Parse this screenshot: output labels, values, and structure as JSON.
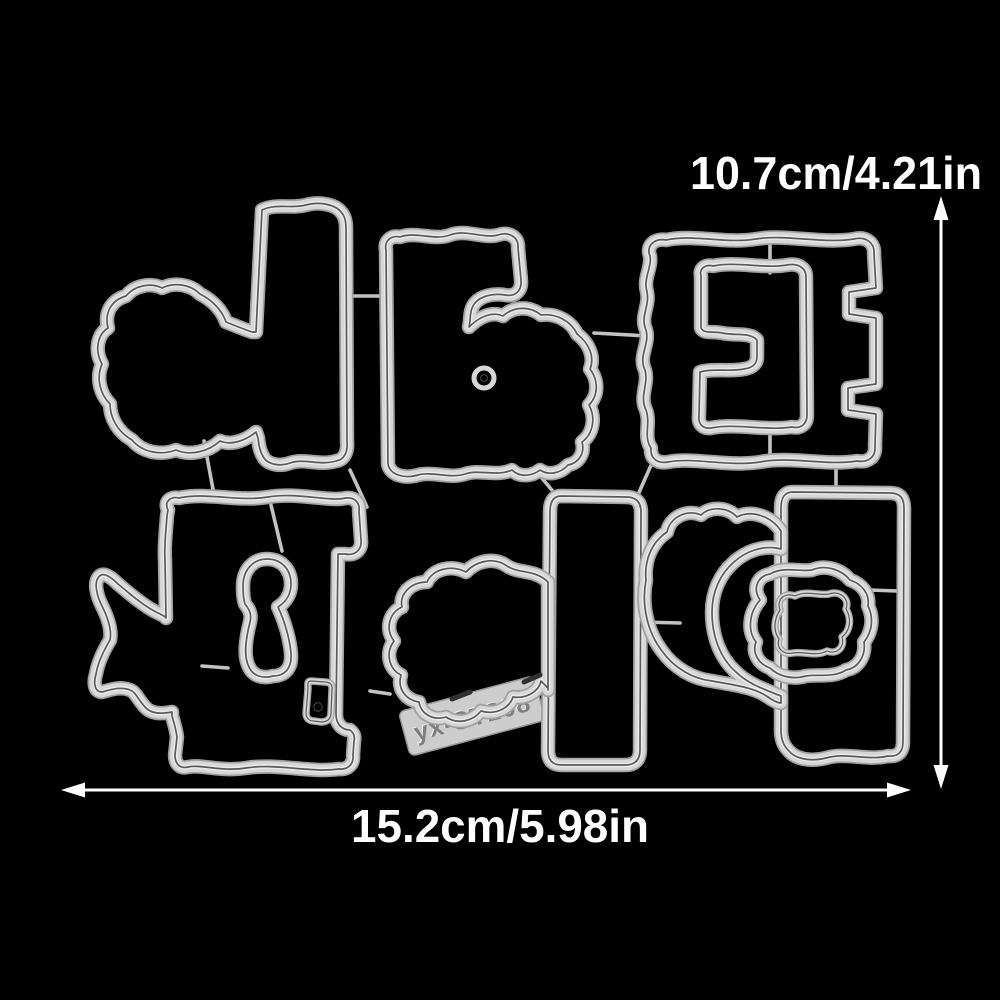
{
  "scene": {
    "description": "Metal craft cutting die set photographed on a black background with dimension annotations",
    "background_color": "#000000"
  },
  "annotations": {
    "height_label": "10.7cm/4.21in",
    "width_label": "15.2cm/5.98in",
    "tag_code": "yx-ST208",
    "text_color": "#ffffff",
    "arrow_color": "#ffffff"
  },
  "die_set": {
    "metal_color": "#d7d7d7",
    "edge_color": "#a0a0a0",
    "groove_color": "#5a5a5a",
    "sprue_color": "#c2c2c2",
    "pieces": [
      "teddy-bear-with-bar-die",
      "block-with-rabbit-die",
      "small-ring-hole-die",
      "square-frame-die",
      "e-shape-inner-die",
      "fish-tail-block-die",
      "keyhole-inner-die",
      "slot-die",
      "sheep-blob-with-column-die",
      "code-label-tag",
      "arch-with-frame-die",
      "blob-inner-die"
    ]
  }
}
